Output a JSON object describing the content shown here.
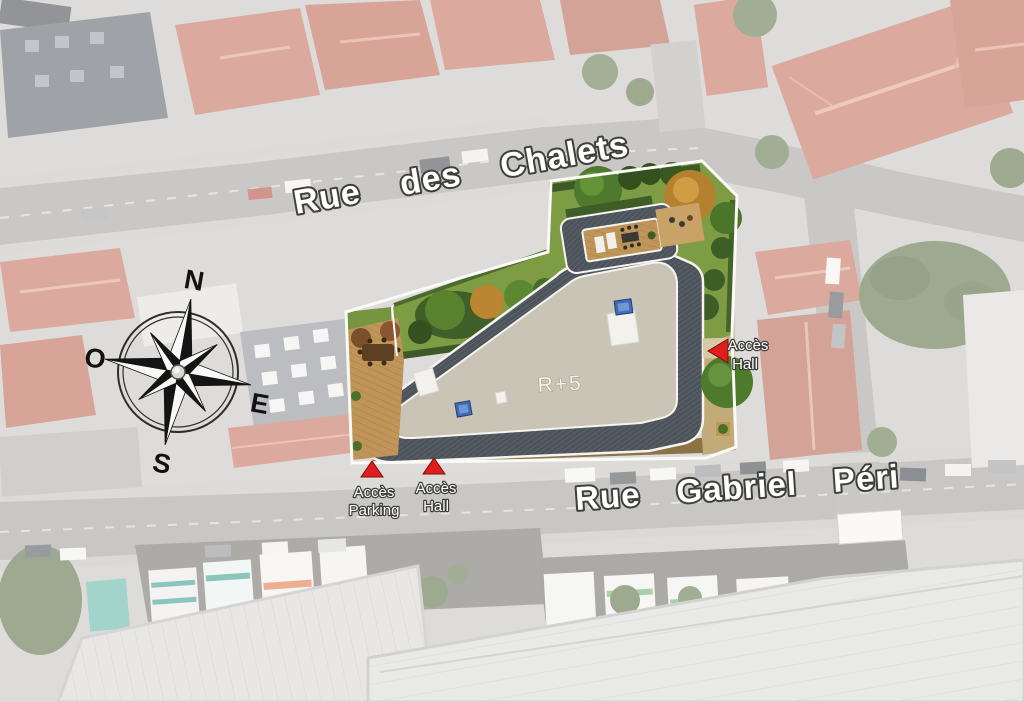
{
  "site_plan": {
    "streets": [
      {
        "name": "Rue des Chalets"
      },
      {
        "name": "Rue Gabriel Péri"
      }
    ],
    "building": {
      "label": "R+5"
    },
    "access_markers": [
      {
        "line1": "Accès",
        "line2": "Hall",
        "location": "east"
      },
      {
        "line1": "Accès",
        "line2": "Parking",
        "location": "south-west"
      },
      {
        "line1": "Accès",
        "line2": "Hall",
        "location": "south"
      }
    ],
    "compass": {
      "north": "N",
      "east": "E",
      "south": "S",
      "west": "O"
    },
    "colors": {
      "marker_red": "#e11d1d",
      "roof_band": "#4d535b",
      "flat_roof": "#c9c4b5",
      "lawn_green": "#7d9c44",
      "deck_wood": "#c09559",
      "street_label": "#ffffff"
    }
  }
}
